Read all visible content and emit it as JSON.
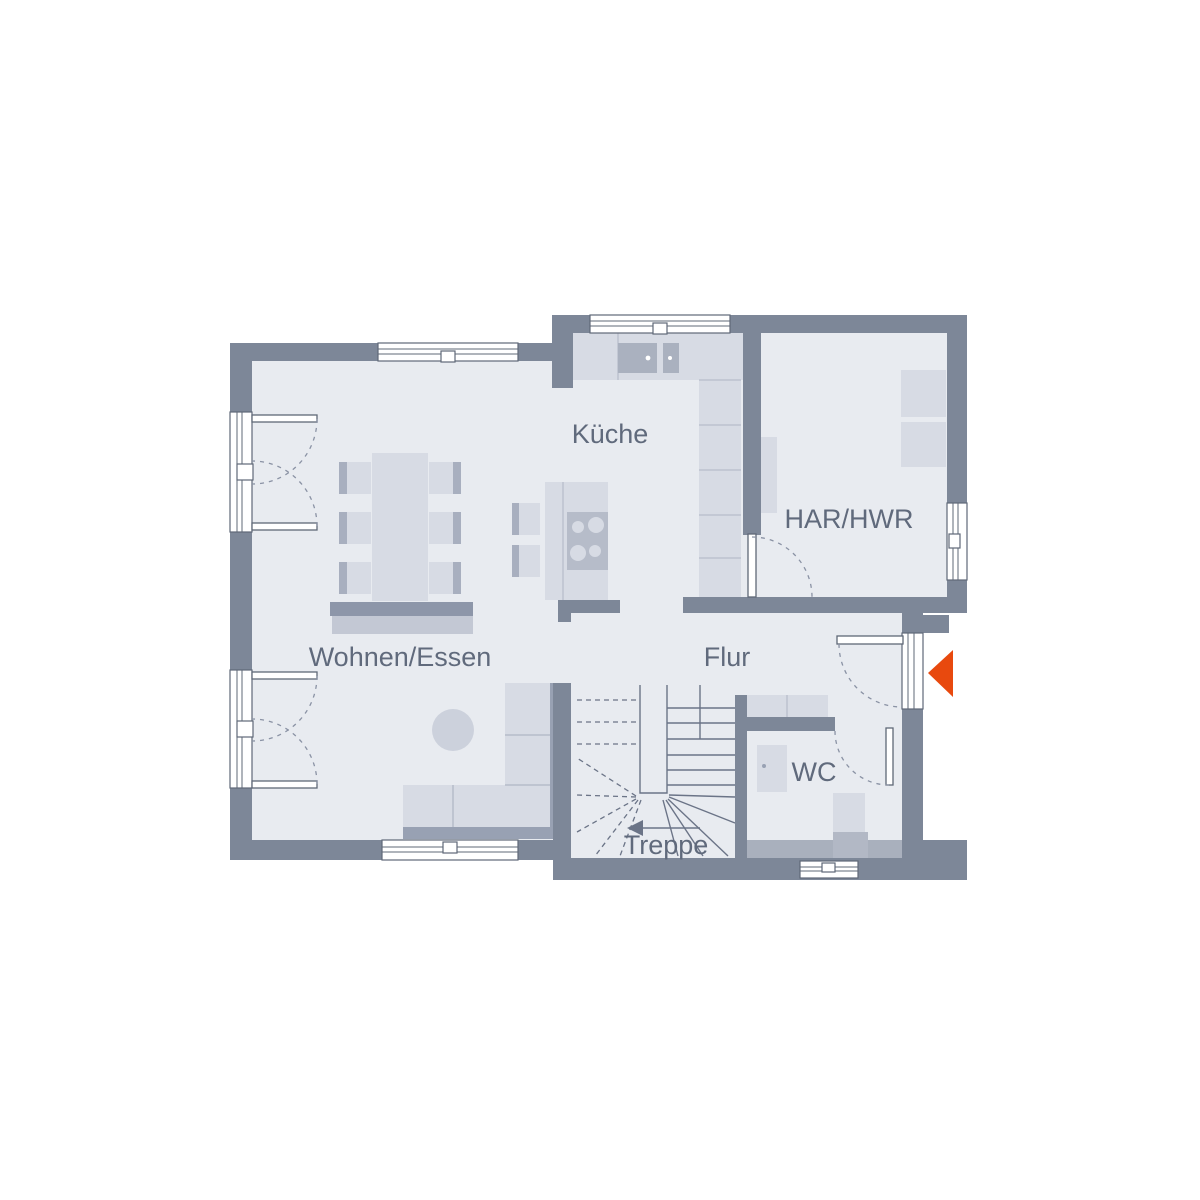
{
  "plan": {
    "title": "floor-plan-ground-floor",
    "rooms": [
      {
        "id": "kueche",
        "label": "Küche"
      },
      {
        "id": "har-hwr",
        "label": "HAR/HWR"
      },
      {
        "id": "wohnen-essen",
        "label": "Wohnen/Essen"
      },
      {
        "id": "flur",
        "label": "Flur"
      },
      {
        "id": "wc",
        "label": "WC"
      },
      {
        "id": "treppe",
        "label": "Treppe"
      }
    ],
    "entrance_marker": {
      "shape": "triangle-pointing-left",
      "meaning": "entrance"
    },
    "colors": {
      "background": "#ffffff",
      "wall": "#7d8798",
      "floor": "#e8ebf0",
      "furniture_light": "#d7dbe4",
      "furniture_mid": "#c3c8d4",
      "furniture_dark": "#98a1b3",
      "furniture_shadow": "#8d96a9",
      "seat_accent": "#a8afbf",
      "appliance_inner": "#b6bcc9",
      "basin": "#aab1bf",
      "ledge": "#a9b0bd",
      "toilet_base": "#b2b8c5",
      "circle_table": "#ccd1dc",
      "line": "#6b7487",
      "dash": "#8a92a4",
      "frame_stroke": "#5f6877",
      "label_text": "#606a7c",
      "entrance_marker": "#e8490e"
    }
  }
}
